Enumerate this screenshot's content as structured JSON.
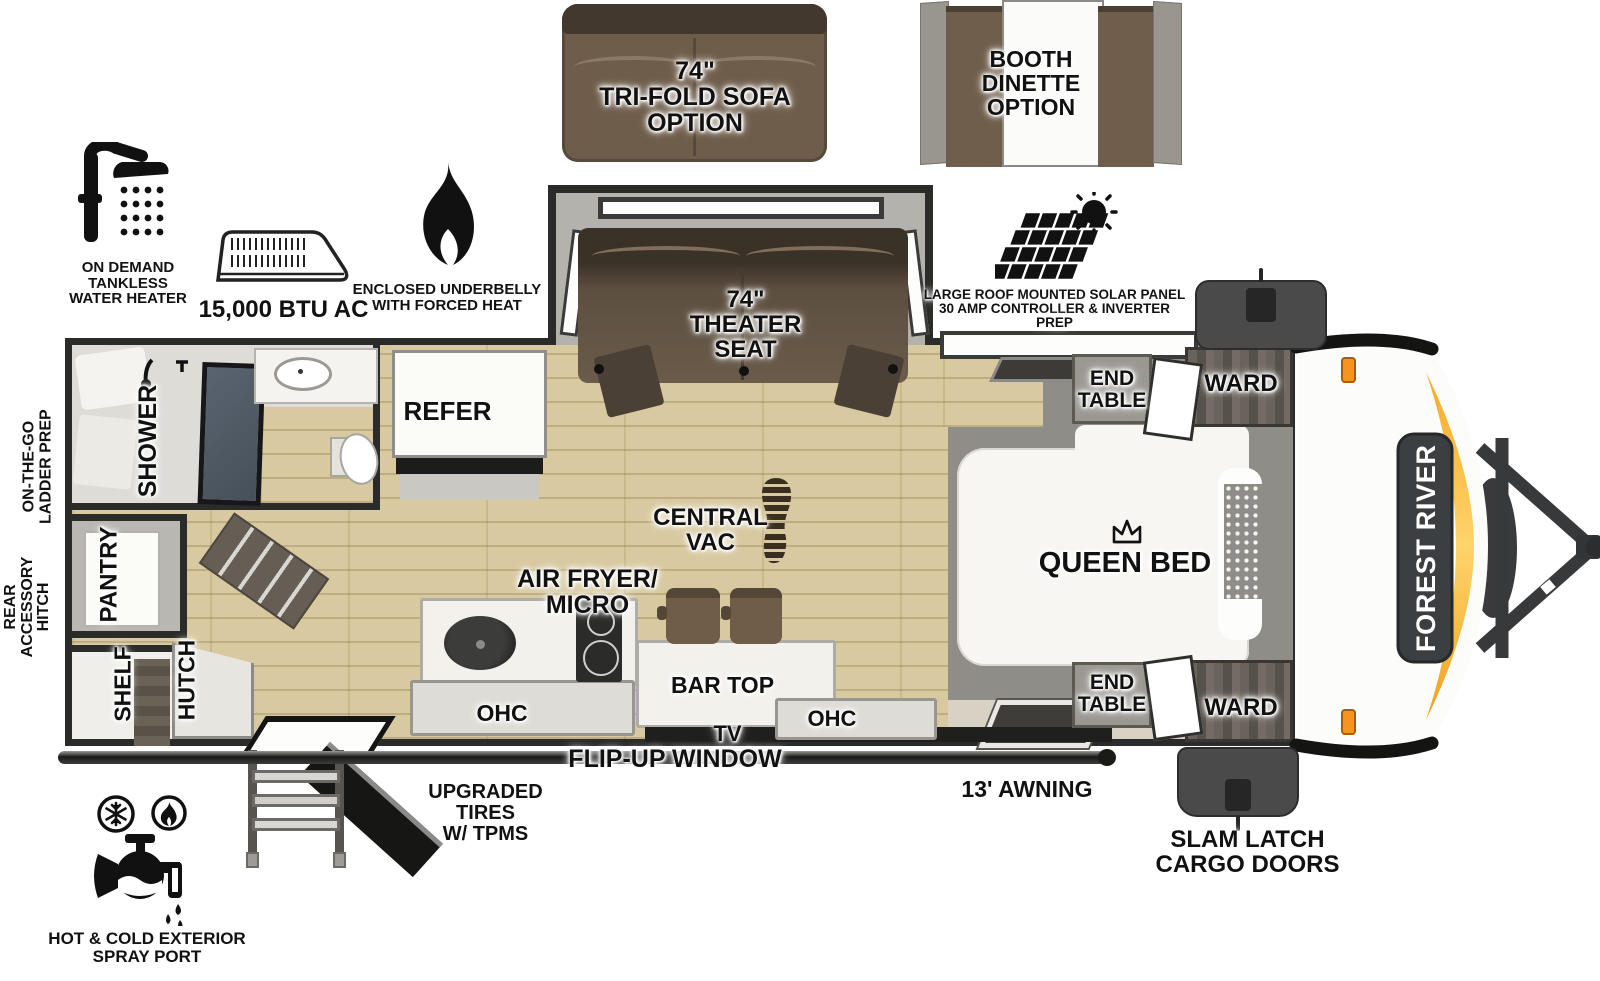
{
  "title": "Forest River travel trailer floorplan",
  "brand": {
    "name": "FOREST RIVER"
  },
  "options": {
    "trifold_sofa": "74\"\nTRI-FOLD SOFA\nOPTION",
    "booth_dinette": "BOOTH\nDINETTE\nOPTION"
  },
  "features": {
    "water_heater": "ON DEMAND\nTANKLESS\nWATER HEATER",
    "ac": "15,000 BTU AC",
    "underbelly": "ENCLOSED UNDERBELLY\nWITH FORCED HEAT",
    "solar": "LARGE ROOF MOUNTED SOLAR PANEL\n30 AMP CONTROLLER & INVERTER PREP",
    "central_vac": "CENTRAL\nVAC"
  },
  "rooms": {
    "theater_seat": "74\"\nTHEATER\nSEAT",
    "refer": "REFER",
    "shower": "SHOWER",
    "pantry": "PANTRY",
    "shelf": "SHELF",
    "hutch": "HUTCH",
    "air_fryer_micro": "AIR FRYER/\nMICRO",
    "bar_top": "BAR TOP",
    "ohc_left": "OHC",
    "ohc_right": "OHC",
    "tv": "TV",
    "queen_bed": "QUEEN BED",
    "end_table_top": "END\nTABLE",
    "end_table_bottom": "END\nTABLE",
    "ward_top": "WARD",
    "ward_bottom": "WARD"
  },
  "exterior": {
    "ladder_prep": "ON-THE-GO\nLADDER PREP",
    "rear_hitch": "REAR\nACCESSORY\nHITCH",
    "upgraded_tires": "UPGRADED TIRES\nW/ TPMS",
    "flip_up_window": "FLIP-UP WINDOW",
    "awning": "13' AWNING",
    "slam_latch": "SLAM LATCH\nCARGO DOORS",
    "spray_port": "HOT & COLD EXTERIOR\nSPRAY PORT"
  },
  "colors": {
    "wall": "#2b2b29",
    "wood_floor": "#d8c9a0",
    "slide_gray": "#b4b2ad",
    "sofa_brown": "#6f5d4b",
    "seat_brown": "#5d4f40",
    "platform_gray": "#8f8d88",
    "accent_orange": "#f5a51f",
    "badge_gray": "#3c3f42",
    "cargo_gray": "#4a4a4a"
  }
}
